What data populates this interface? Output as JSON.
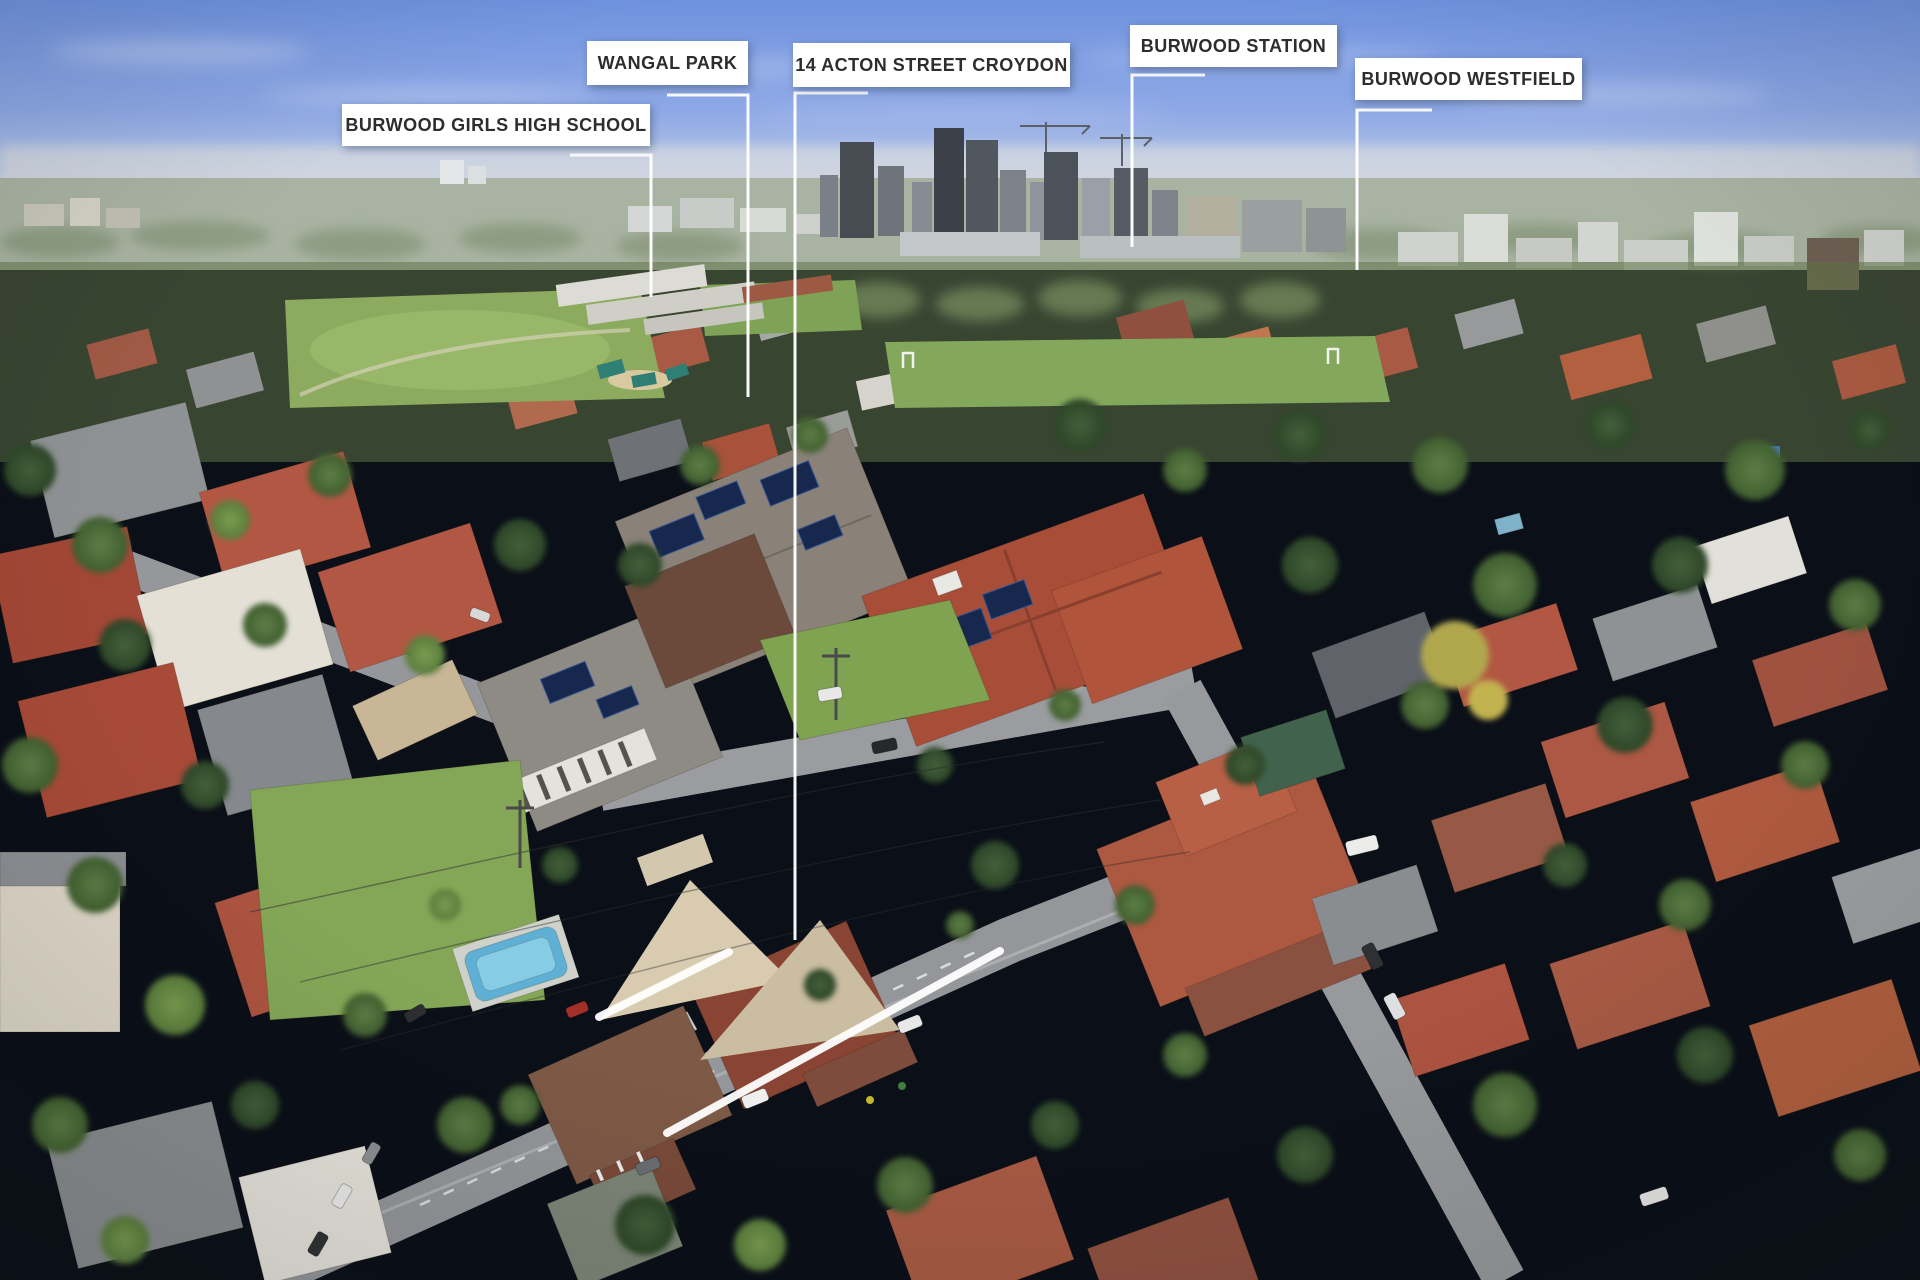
{
  "callouts": [
    {
      "id": "burwood-girls-high-school",
      "text": "BURWOOD GIRLS HIGH SCHOOL"
    },
    {
      "id": "wangal-park",
      "text": "WANGAL PARK"
    },
    {
      "id": "14-acton-street-croydon",
      "text": "14 ACTON STREET CROYDON"
    },
    {
      "id": "burwood-station",
      "text": "BURWOOD STATION"
    },
    {
      "id": "burwood-westfield",
      "text": "BURWOOD WESTFIELD"
    }
  ],
  "style": {
    "label_background": "#ffffff",
    "label_text_color": "#2d2d2d",
    "annotation_line_color": "#ffffff",
    "sky_top": "#6f92df",
    "sky_horizon": "#c9d3ea"
  }
}
